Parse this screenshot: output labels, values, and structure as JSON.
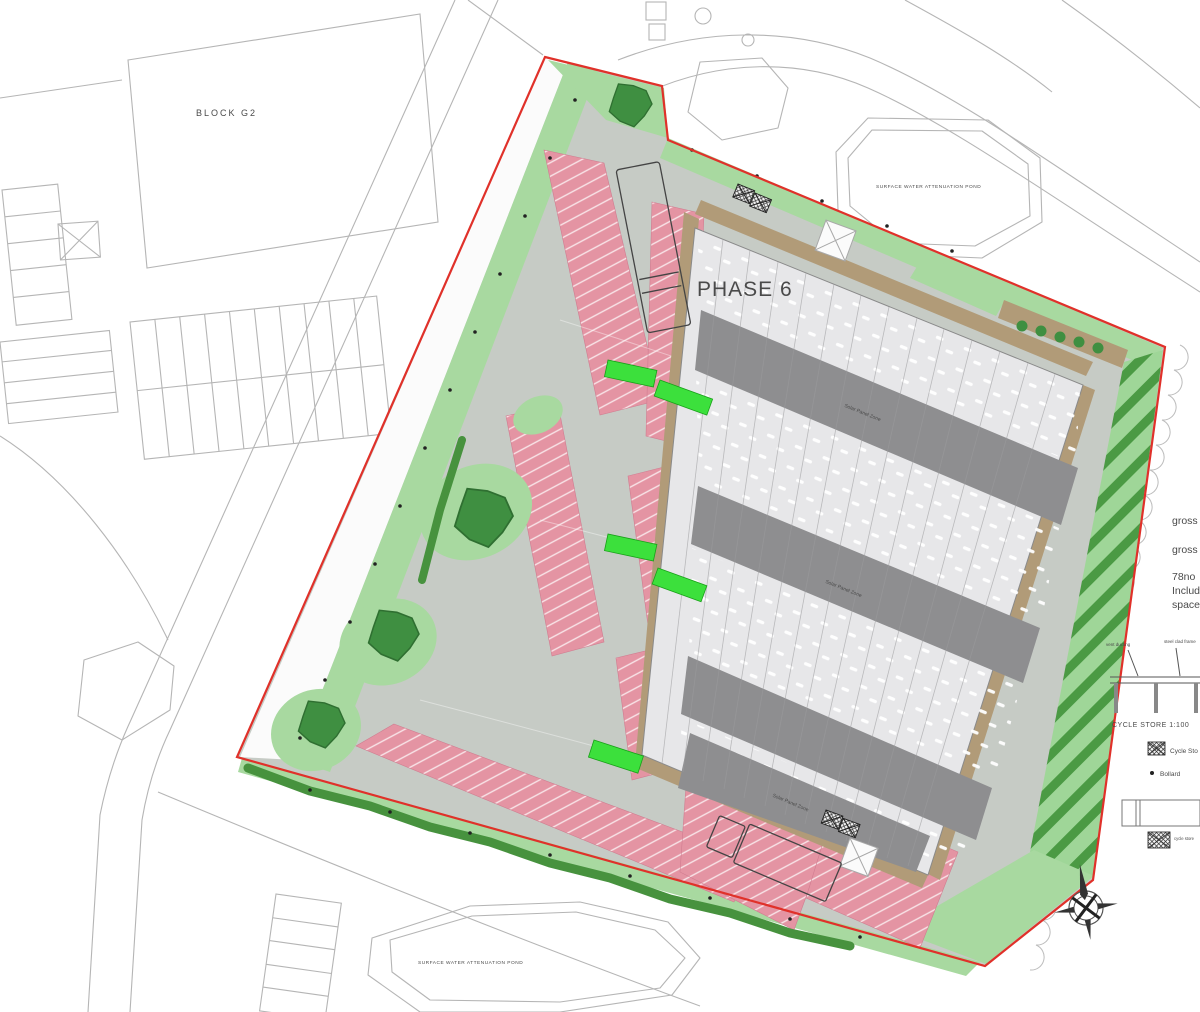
{
  "colors": {
    "boundary_red": "#e0312a",
    "paving_gray": "#c6cbc5",
    "landscape_green": "#a8d9a0",
    "tree_green": "#3f8f41",
    "parking_pink": "#e494a3",
    "roof_dark_gray": "#8e8e90",
    "building_light": "#e7e7e9",
    "path_brown": "#b19b78",
    "ev_bright_green": "#3ce03c",
    "context_line_gray": "#b5b5b5"
  },
  "plan": {
    "phase_label": "PHASE 6",
    "block_label": "BLOCK G2",
    "road_label": "DIAMOND DRIVE",
    "pond_label_top": "SURFACE WATER ATTENUATION POND",
    "pond_label_bottom": "SURFACE WATER ATTENUATION POND",
    "roof_labels": [
      "Solar Panel Zone",
      "Solar Panel Zone",
      "Solar Panel Zone"
    ]
  },
  "side_notes": {
    "lines": [
      "gross",
      "gross",
      "78no",
      "Includ",
      "space"
    ]
  },
  "cycle_store_detail": {
    "title": "CYCLE STORE 1:100",
    "callout_left": "vent ducting",
    "callout_right": "steel clad frame"
  },
  "legend": {
    "cycle_store_label": "Cycle Sto",
    "bollard_label": "Bollard",
    "store_plan_note": "cycle store"
  }
}
